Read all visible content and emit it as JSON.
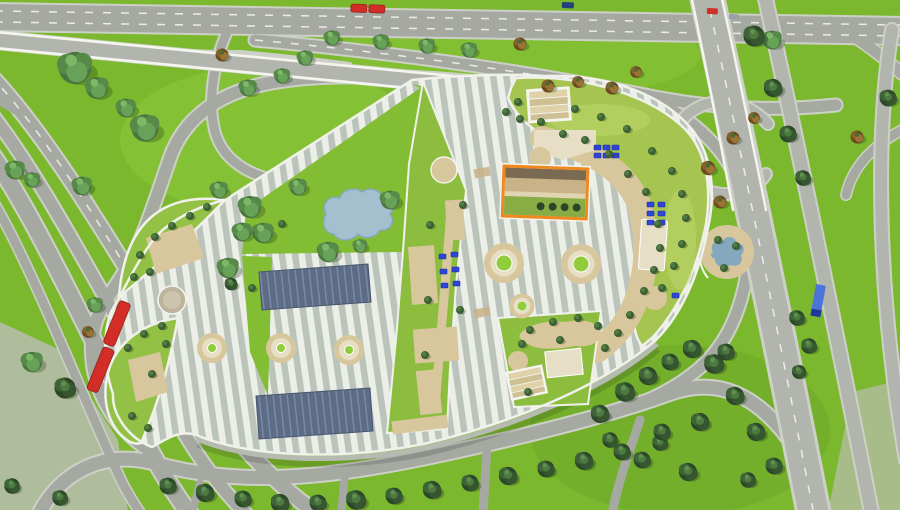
{
  "meta": {
    "kind": "architectural-aerial-site-plan-rendering",
    "view": "top-down bird's-eye 3D render",
    "size": {
      "width": 900,
      "height": 510
    }
  },
  "palette": {
    "grass": "#7cb82e",
    "grass_light": "#90cc3c",
    "grass_dark": "#689f26",
    "concrete": "#b9bdb0",
    "road": "#a6a9a2",
    "road_light": "#b2b5ae",
    "sidewalk": "#cdd0c7",
    "lane_white": "#f2f3ec",
    "rail_white": "#f4f5ef",
    "stripe_light": "#eceee8",
    "stripe_dark": "#bac4bb",
    "parapet": "#f0f1eb",
    "facade": "#b6bbb1",
    "roof_green": "#a6c550",
    "roof_green_light": "#bcd56a",
    "leaf_green": "#93c145",
    "lawn_green": "#83bd33",
    "section_green": "#8cbd3e",
    "court_green": "#89ad45",
    "court_tan": "#c9b287",
    "court_band": "#7a6a52",
    "court_strip": "#e0d4b2",
    "court_tree": "#2c4526",
    "tan": "#d8c79c",
    "tan_light": "#e7dfc5",
    "tan_dark": "#c9b287",
    "gravel": "#bdb49c",
    "panel": "#5c6b86",
    "panel_stripe": "#7b89a2",
    "orange": "#f08820",
    "pond": "#a4c0cf",
    "pond_deep": "#86a8bd",
    "bench": "#2f45d8",
    "bench_dark": "#1c2f9e",
    "bus_red": "#d22d26",
    "car_red": "#d03028",
    "car_gray": "#9aa0a6",
    "car_navy": "#27407c",
    "truck_blue": "#4a74d8",
    "truck_cab": "#20389c",
    "step_a": "#dfd2a8",
    "step_b": "#cfc094",
    "fir1": "#2c4729",
    "fir2": "#35562f",
    "fir3": "#3e6337",
    "fir4": "#4c7a41",
    "fir5": "#5f9150",
    "dec1": "#4a7540",
    "dec2": "#578a49",
    "dec3": "#68a258",
    "dec4": "#7cb866",
    "orn1": "#6b4a22",
    "orn2": "#85612b",
    "orn3": "#9b7434",
    "orn4": "#4c6a34",
    "bsh1": "#3c5f33",
    "bsh2": "#4f7c42"
  },
  "scene": {
    "building": {
      "roof_finish": "white-gray ribbed metal stripes",
      "green_roof_sections": 6,
      "solar_panel_arrays": 2,
      "circular_skylight_planters": 6,
      "gravel_circles": 2,
      "stair_terraces": 2,
      "orange_framed_courtyard": 1,
      "courtyard_trees": 4,
      "rooftop_pond": 1,
      "bench_groups": 3,
      "benches_blue_total": 19
    },
    "landscape": {
      "ground_pond_garden": 1,
      "highway_interchange": "east side with overpass and loop ramp",
      "overpass_bridge": "northwest with white guard rails",
      "boulevard": "multi-lane with green medians, west and southwest",
      "tree_types": [
        "conifer",
        "deciduous",
        "autumn-orange",
        "shrub"
      ]
    },
    "vehicles": [
      {
        "name": "articulated-bus",
        "color_key": "bus_red",
        "location": "top road"
      },
      {
        "name": "articulated-bus",
        "color_key": "bus_red",
        "location": "left boulevard"
      },
      {
        "name": "car",
        "color_key": "car_red",
        "location": "top road"
      },
      {
        "name": "car",
        "color_key": "car_gray",
        "location": "top road"
      },
      {
        "name": "car",
        "color_key": "car_navy",
        "location": "top road"
      },
      {
        "name": "truck",
        "color_key": "truck_blue",
        "location": "east highway"
      }
    ]
  }
}
